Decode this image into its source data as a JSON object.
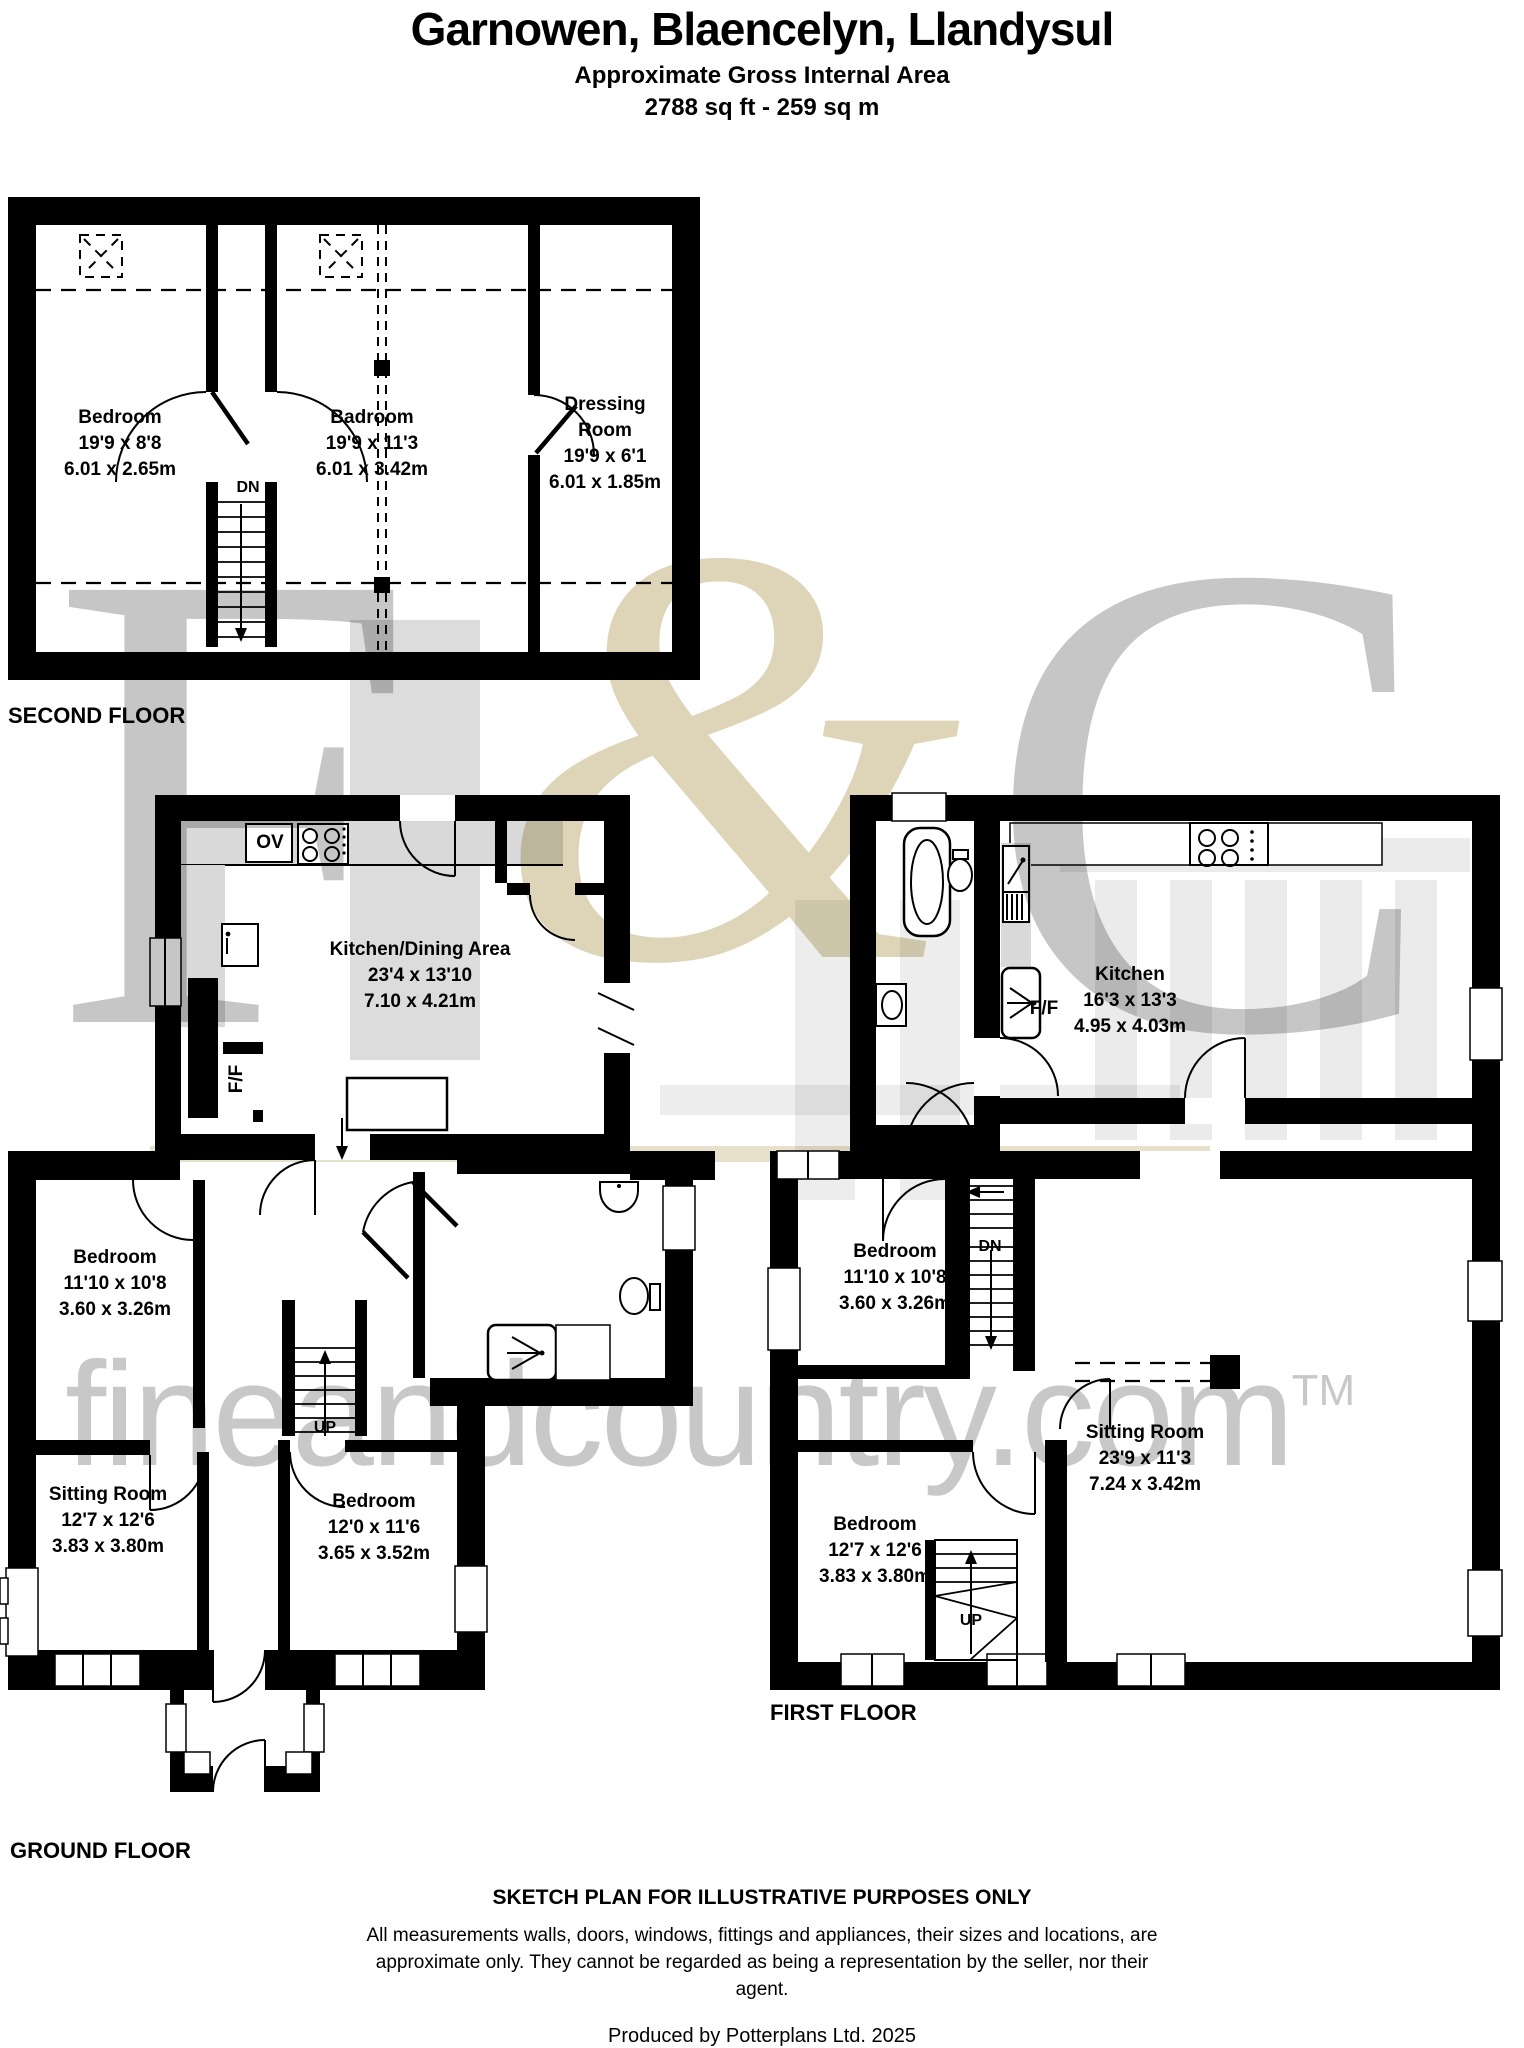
{
  "header": {
    "title": "Garnowen, Blaencelyn, Llandysul",
    "subtitle": "Approximate Gross Internal Area",
    "area": "2788 sq ft - 259 sq m"
  },
  "floors": {
    "second": {
      "label": "SECOND FLOOR",
      "stairs_down": "DN",
      "rooms": {
        "bedroom": {
          "name": "Bedroom",
          "size_ft": "19'9 x 8'8",
          "size_m": "6.01 x 2.65m"
        },
        "badroom": {
          "name": "Badroom",
          "size_ft": "19'9 x 11'3",
          "size_m": "6.01 x 3.42m"
        },
        "dressing": {
          "name": "Dressing Room",
          "size_ft": "19'9 x 6'1",
          "size_m": "6.01 x 1.85m"
        }
      }
    },
    "ground": {
      "label": "GROUND FLOOR",
      "oven": "OV",
      "fridge": "F/F",
      "stairs_up": "UP",
      "rooms": {
        "kitchen": {
          "name": "Kitchen/Dining Area",
          "size_ft": "23'4 x 13'10",
          "size_m": "7.10 x 4.21m"
        },
        "bedroom1": {
          "name": "Bedroom",
          "size_ft": "11'10 x 10'8",
          "size_m": "3.60 x 3.26m"
        },
        "sitting": {
          "name": "Sitting Room",
          "size_ft": "12'7 x 12'6",
          "size_m": "3.83 x 3.80m"
        },
        "bedroom2": {
          "name": "Bedroom",
          "size_ft": "12'0 x 11'6",
          "size_m": "3.65 x 3.52m"
        }
      }
    },
    "first": {
      "label": "FIRST FLOOR",
      "fridge": "F/F",
      "stairs_down": "DN",
      "stairs_up": "UP",
      "rooms": {
        "kitchen": {
          "name": "Kitchen",
          "size_ft": "16'3 x 13'3",
          "size_m": "4.95 x 4.03m"
        },
        "bedroom1": {
          "name": "Bedroom",
          "size_ft": "11'10 x 10'8",
          "size_m": "3.60 x 3.26m"
        },
        "sitting": {
          "name": "Sitting Room",
          "size_ft": "23'9 x 11'3",
          "size_m": "7.24 x 3.42m"
        },
        "bedroom2": {
          "name": "Bedroom",
          "size_ft": "12'7 x 12'6",
          "size_m": "3.83 x 3.80m"
        }
      }
    }
  },
  "watermark": {
    "letter_f": "F",
    "ampersand": "&",
    "letter_c": "C",
    "website": "fineandcountry.com",
    "trademark": "TM",
    "gray": "#c6c6c6",
    "beige": "#ded5b8"
  },
  "footer": {
    "heading": "SKETCH PLAN FOR ILLUSTRATIVE PURPOSES ONLY",
    "disclaimer": "All measurements walls, doors, windows, fittings and appliances, their sizes and locations, are approximate only. They cannot be regarded as being a representation by the seller, nor their agent.",
    "credit": "Produced by Potterplans Ltd. 2025"
  }
}
